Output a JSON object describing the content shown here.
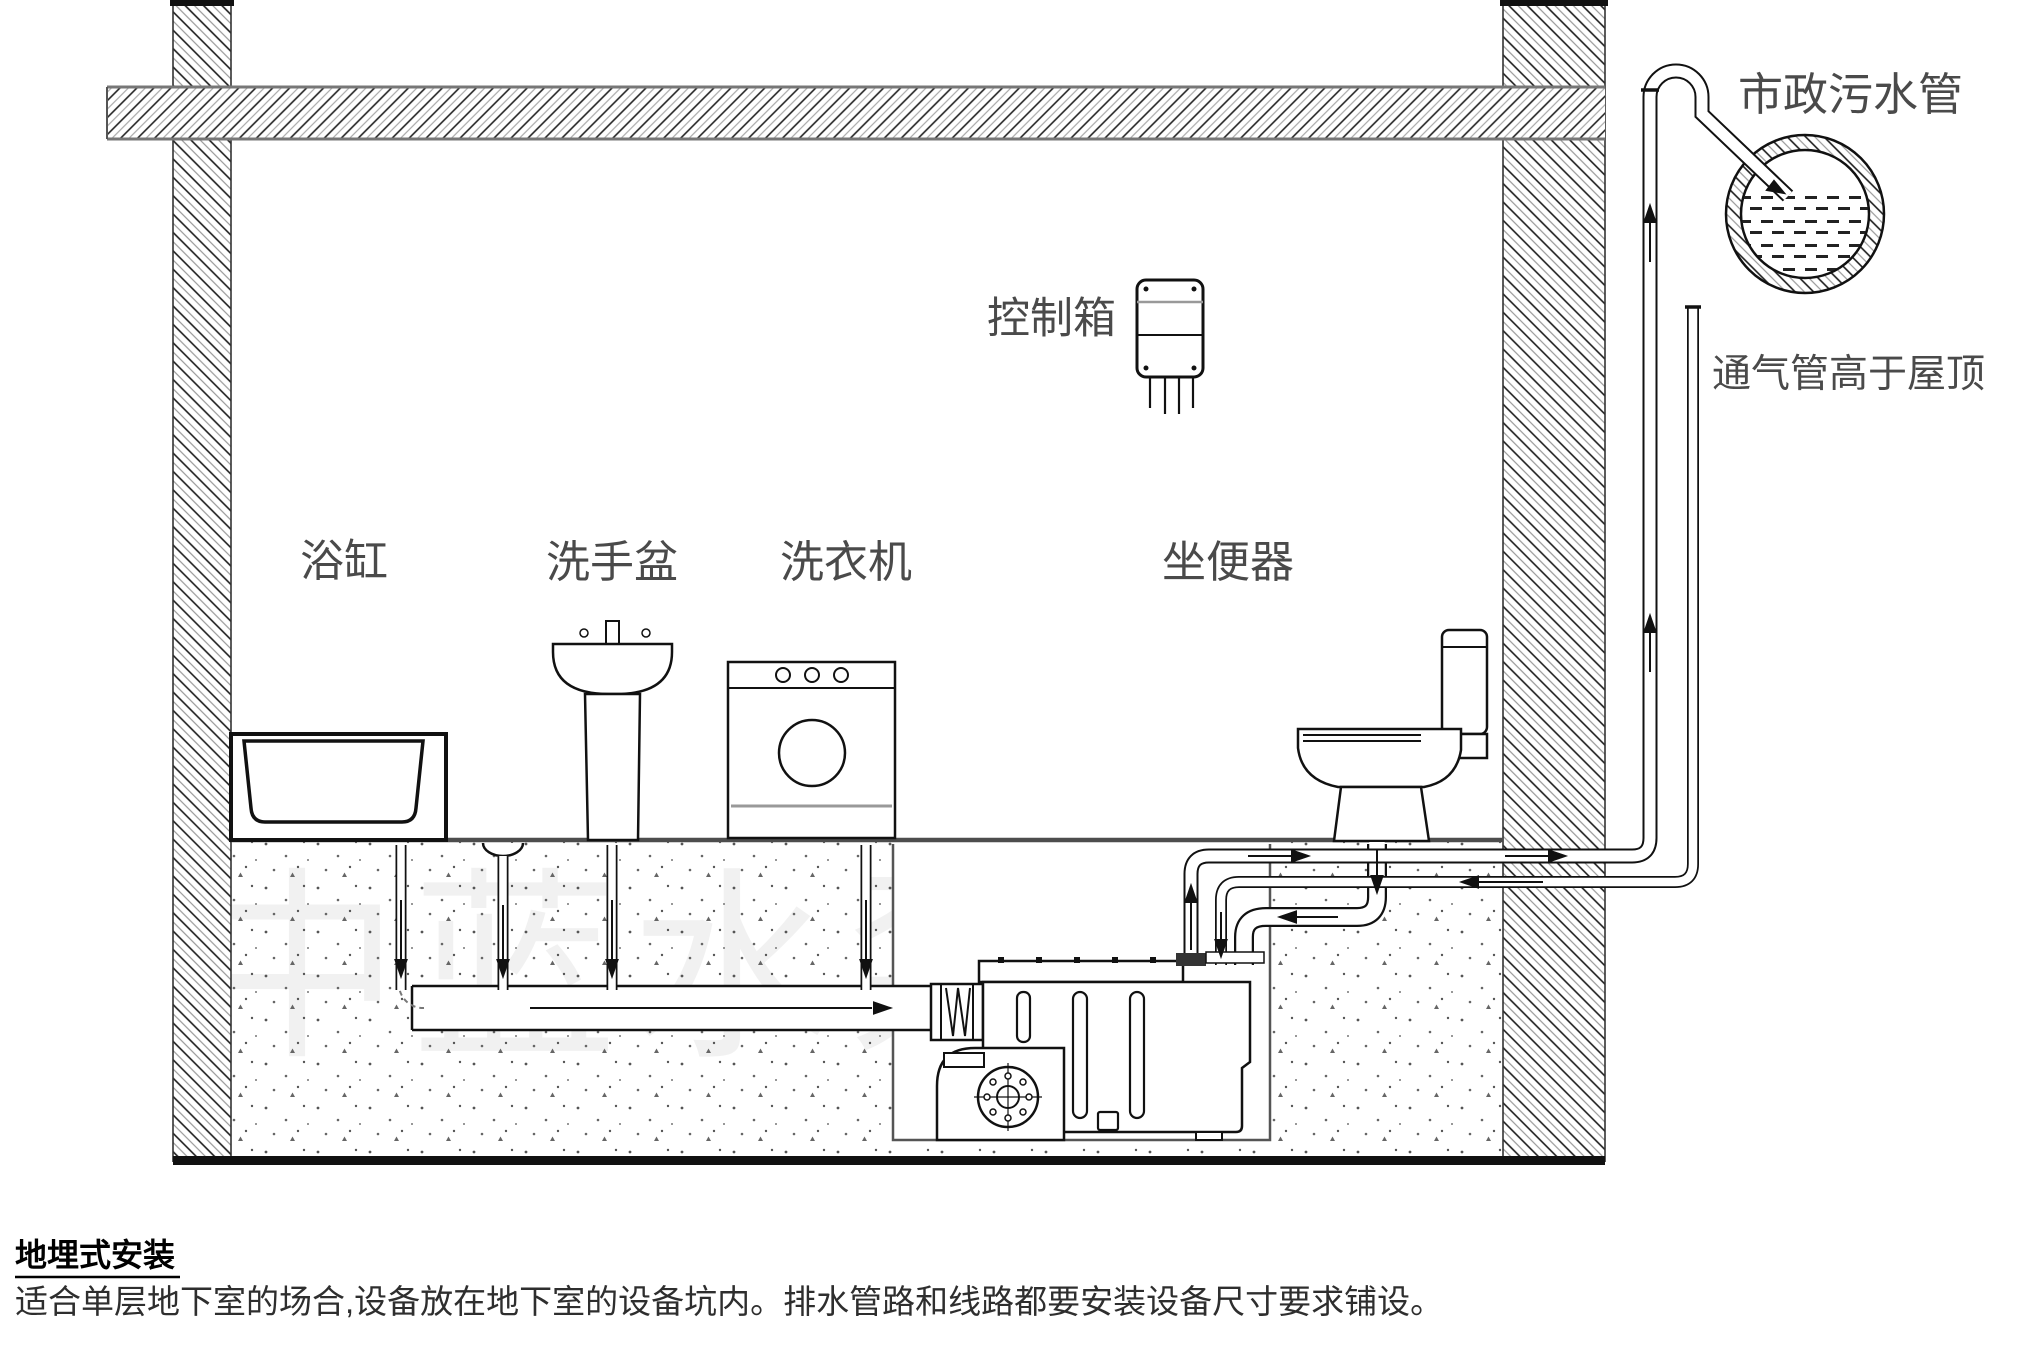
{
  "canvas": {
    "width": 2022,
    "height": 1353,
    "ink": "#1a1a1a",
    "label_color": "#4a4a4a"
  },
  "labels": {
    "bathtub": "浴缸",
    "basin": "洗手盆",
    "washer": "洗衣机",
    "toilet": "坐便器",
    "control_box": "控制箱",
    "municipal_sewer": "市政污水管",
    "vent_note": "通气管高于屋顶"
  },
  "watermark": {
    "text": "中蓝水泵"
  },
  "caption": {
    "heading": "地埋式安装",
    "body": "适合单层地下室的场合,设备放在地下室的设备坑内。排水管路和线路都要安装设备尺寸要求铺设。"
  }
}
